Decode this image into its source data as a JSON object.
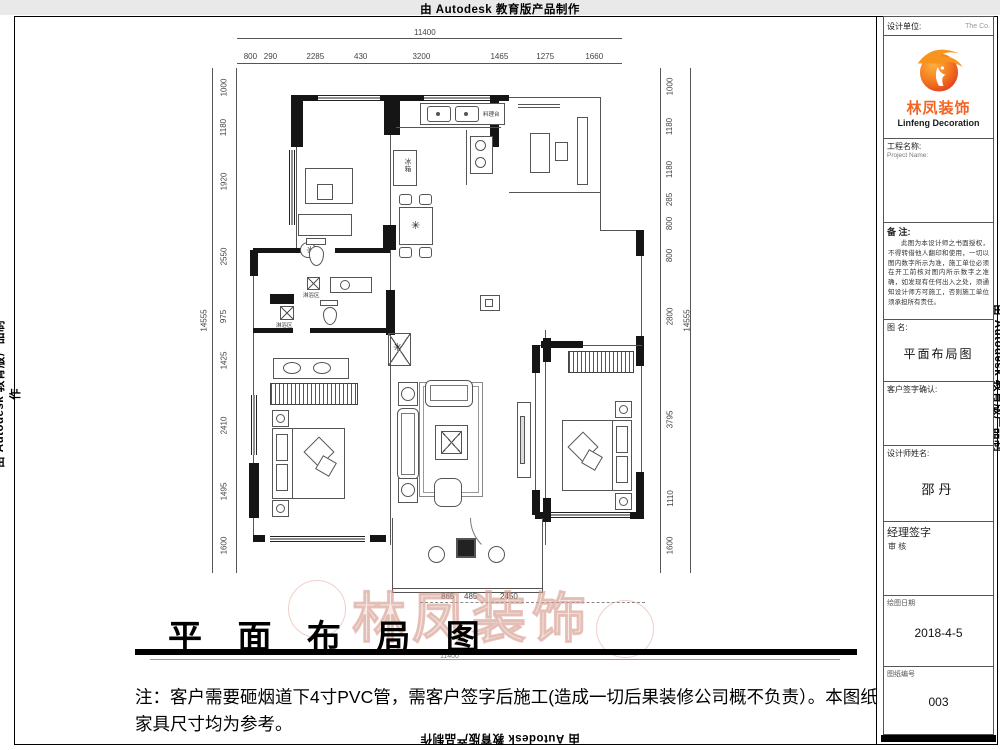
{
  "sheet": {
    "autodesk_credit": "由 Autodesk 教育版产品制作"
  },
  "title_block": {
    "design_unit_label": "设计单位:",
    "design_unit_right": "The  Co.",
    "brand_cn": "林凤装饰",
    "brand_en": "Linfeng Decoration",
    "project_name_label": "工程名称:",
    "project_name_en": "Project Name:",
    "remarks_label": "备 注:",
    "remarks_text": "此图为本设计师之书面授权，不得转借他人翻印和使用，一切以图内数字所示为准，施工单位必须在开工前核对图内所示数字之准确，如发现有任何出入之处，须通知设计师方可施工，否则施工单位须承担所有责任。",
    "drawing_name_label": "图 名:",
    "drawing_name": "平面布局图",
    "customer_sign_label": "客户签字确认:",
    "designer_label": "设计师姓名:",
    "designer_name": "邵丹",
    "manager_sign_label": "经理签字",
    "manager_review": "审  核",
    "date_label": "绘图日期",
    "date_value": "2018-4-5",
    "sheet_no_label": "图纸编号",
    "sheet_no_value": "003",
    "accent_color": "#f26522"
  },
  "plan": {
    "room_labels": {
      "fridge": "冰箱",
      "counter": "料理台",
      "shower_a": "淋浴区",
      "shower_b": "淋浴区"
    },
    "dims": {
      "top_total": "11400",
      "top_segments": [
        "800",
        "290",
        "2285",
        "430",
        "3200",
        "1465",
        "1275",
        "1660"
      ],
      "left_total": "14555",
      "left_segments": [
        "1000",
        "1180",
        "1920",
        "2550",
        "975",
        "1425",
        "2410",
        "1495",
        "1600"
      ],
      "right_total": "14555",
      "right_segments": [
        "1000",
        "1180",
        "1180",
        "285",
        "800",
        "800",
        "2800",
        "3795",
        "1110",
        "1600"
      ],
      "bottom_segments": [
        "865",
        "485",
        "2450"
      ],
      "bottom_total": "11400"
    }
  },
  "footer": {
    "sheet_title": "平 面 布 局 图",
    "note": "注：客户需要砸烟道下4寸PVC管，需客户签字后施工(造成一切后果装修公司概不负责）。本图纸家具尺寸均为参考。"
  },
  "watermark": {
    "text": "林凤装饰"
  }
}
